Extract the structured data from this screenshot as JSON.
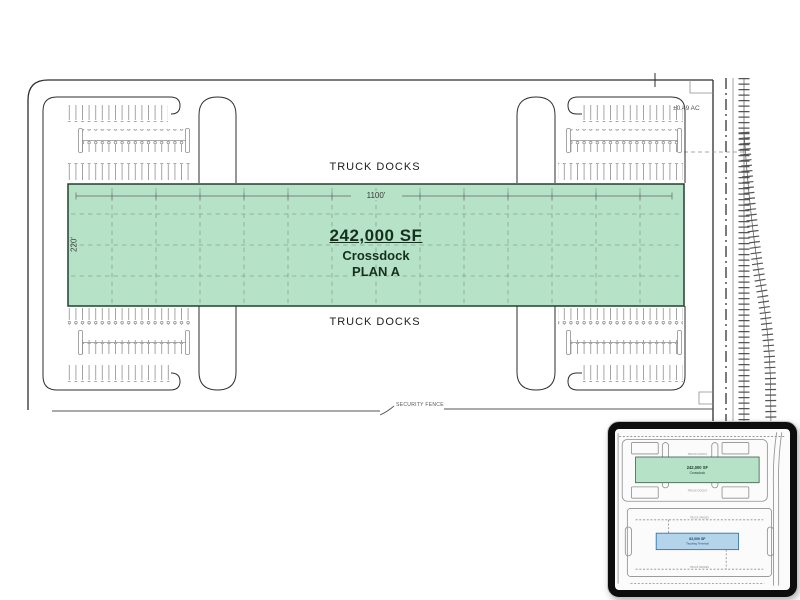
{
  "plan": {
    "truck_docks_top": "TRUCK DOCKS",
    "truck_docks_bottom": "TRUCK DOCKS",
    "building": {
      "area": "242,000 SF",
      "use": "Crossdock",
      "plan": "PLAN A",
      "width": "1100'",
      "depth": "220'"
    },
    "acreage": "±0.49 AC",
    "security_fence": "SECURITY FENCE"
  },
  "inset": {
    "crossdock": {
      "area": "242,000 SF",
      "name": "Crossdock"
    },
    "terminal": {
      "area": "62,000 SF",
      "name": "Trucking Terminal"
    },
    "truck_docks_top": "TRUCK DOCKS",
    "truck_docks_bottom": "TRUCK DOCKS",
    "truck_spaces_top": "TRUCK SPACES",
    "truck_spaces_bottom": "TRUCK SPACES"
  },
  "colors": {
    "building-green": "#b6e2c8",
    "building-border": "#23402e",
    "building-text": "#15301e",
    "terminal-blue": "#b3d4eb",
    "terminal-border": "#2f6da8",
    "line-dark": "#2e2e2e",
    "line-gray": "#8f8f8f",
    "grid-green": "#86a794"
  }
}
